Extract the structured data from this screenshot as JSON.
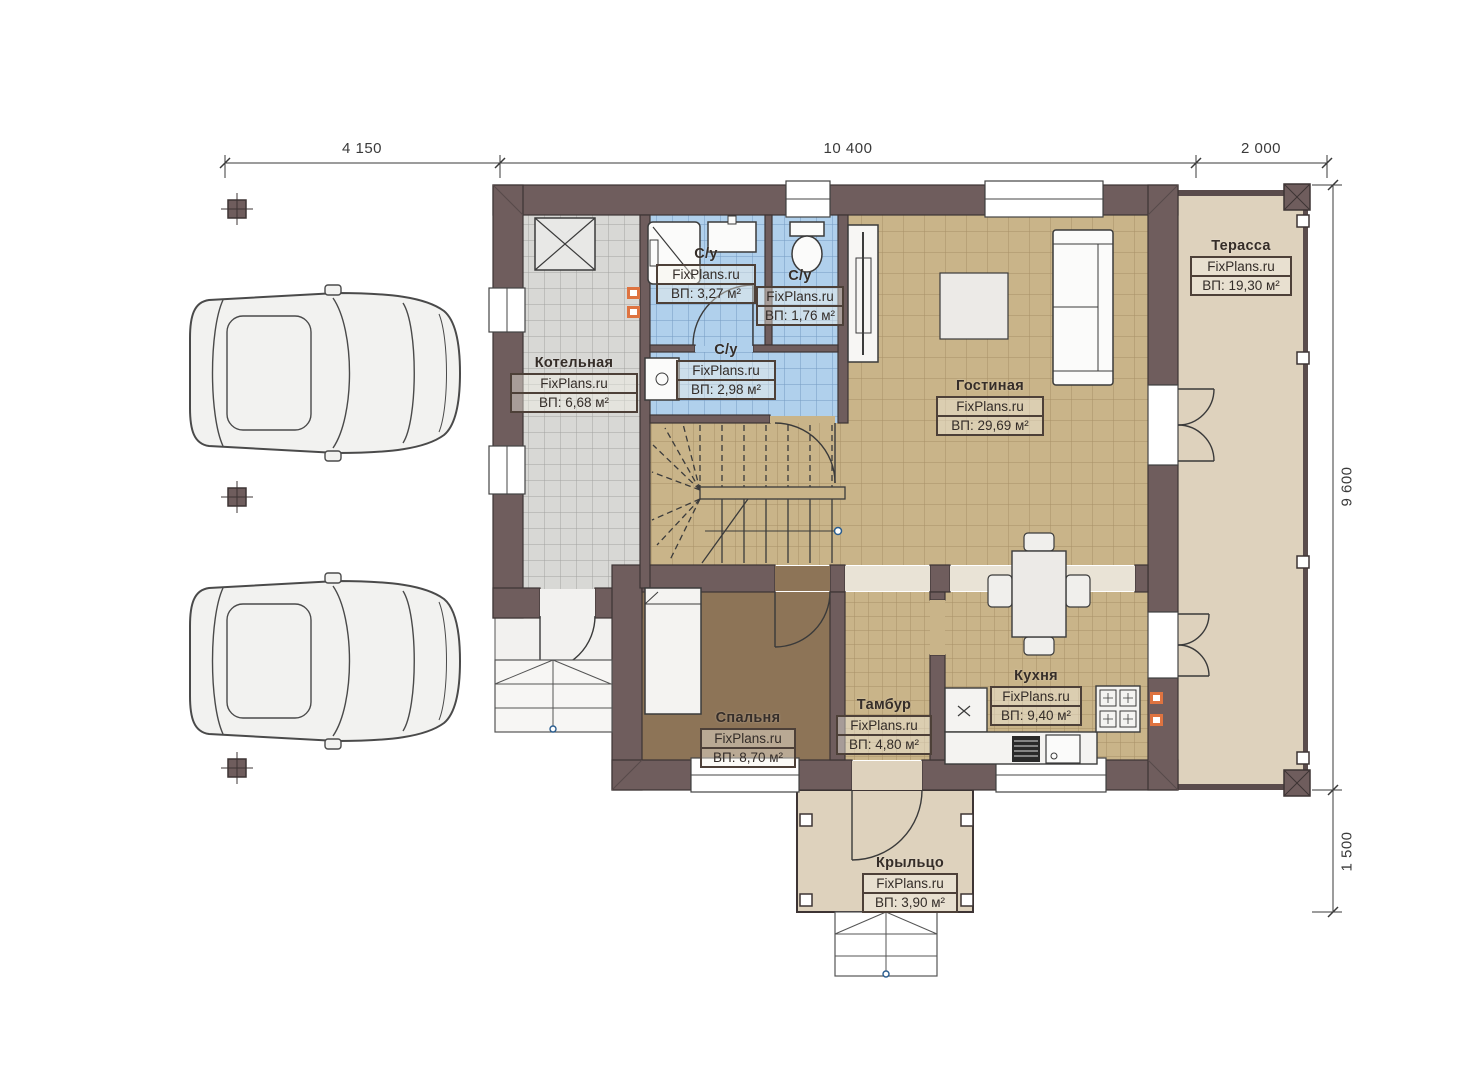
{
  "dimensions": {
    "top": [
      "4 150",
      "10 400",
      "2 000"
    ],
    "right": [
      "9 600",
      "1 500"
    ]
  },
  "rooms": [
    {
      "id": "kotelnaya",
      "name": "Котельная",
      "brand": "FixPlans.ru",
      "area": "ВП: 6,68 м²"
    },
    {
      "id": "su-shower",
      "name": "С/у",
      "brand": "FixPlans.ru",
      "area": "ВП: 3,27 м²"
    },
    {
      "id": "su-wc",
      "name": "С/у",
      "brand": "FixPlans.ru",
      "area": "ВП: 1,76 м²"
    },
    {
      "id": "su-lower",
      "name": "С/у",
      "brand": "FixPlans.ru",
      "area": "ВП: 2,98 м²"
    },
    {
      "id": "gostinaya",
      "name": "Гостиная",
      "brand": "FixPlans.ru",
      "area": "ВП: 29,69 м²"
    },
    {
      "id": "terassa",
      "name": "Терасса",
      "brand": "FixPlans.ru",
      "area": "ВП: 19,30 м²"
    },
    {
      "id": "spalnya",
      "name": "Спальня",
      "brand": "FixPlans.ru",
      "area": "ВП: 8,70 м²"
    },
    {
      "id": "tambur",
      "name": "Тамбур",
      "brand": "FixPlans.ru",
      "area": "ВП: 4,80 м²"
    },
    {
      "id": "kuhnya",
      "name": "Кухня",
      "brand": "FixPlans.ru",
      "area": "ВП: 9,40 м²"
    },
    {
      "id": "krylco",
      "name": "Крыльцо",
      "brand": "FixPlans.ru",
      "area": "ВП: 3,90 м²"
    }
  ],
  "colors": {
    "wall": "#6f5d5d",
    "wall_outline": "#3d3434",
    "floor_main": "#c9b489",
    "floor_bath": "#b0d0ec",
    "floor_boiler": "#d8d8d5",
    "floor_bedroom": "#8d7457",
    "floor_terrace": "#ded2bd",
    "vent_marker": "#de7340"
  }
}
